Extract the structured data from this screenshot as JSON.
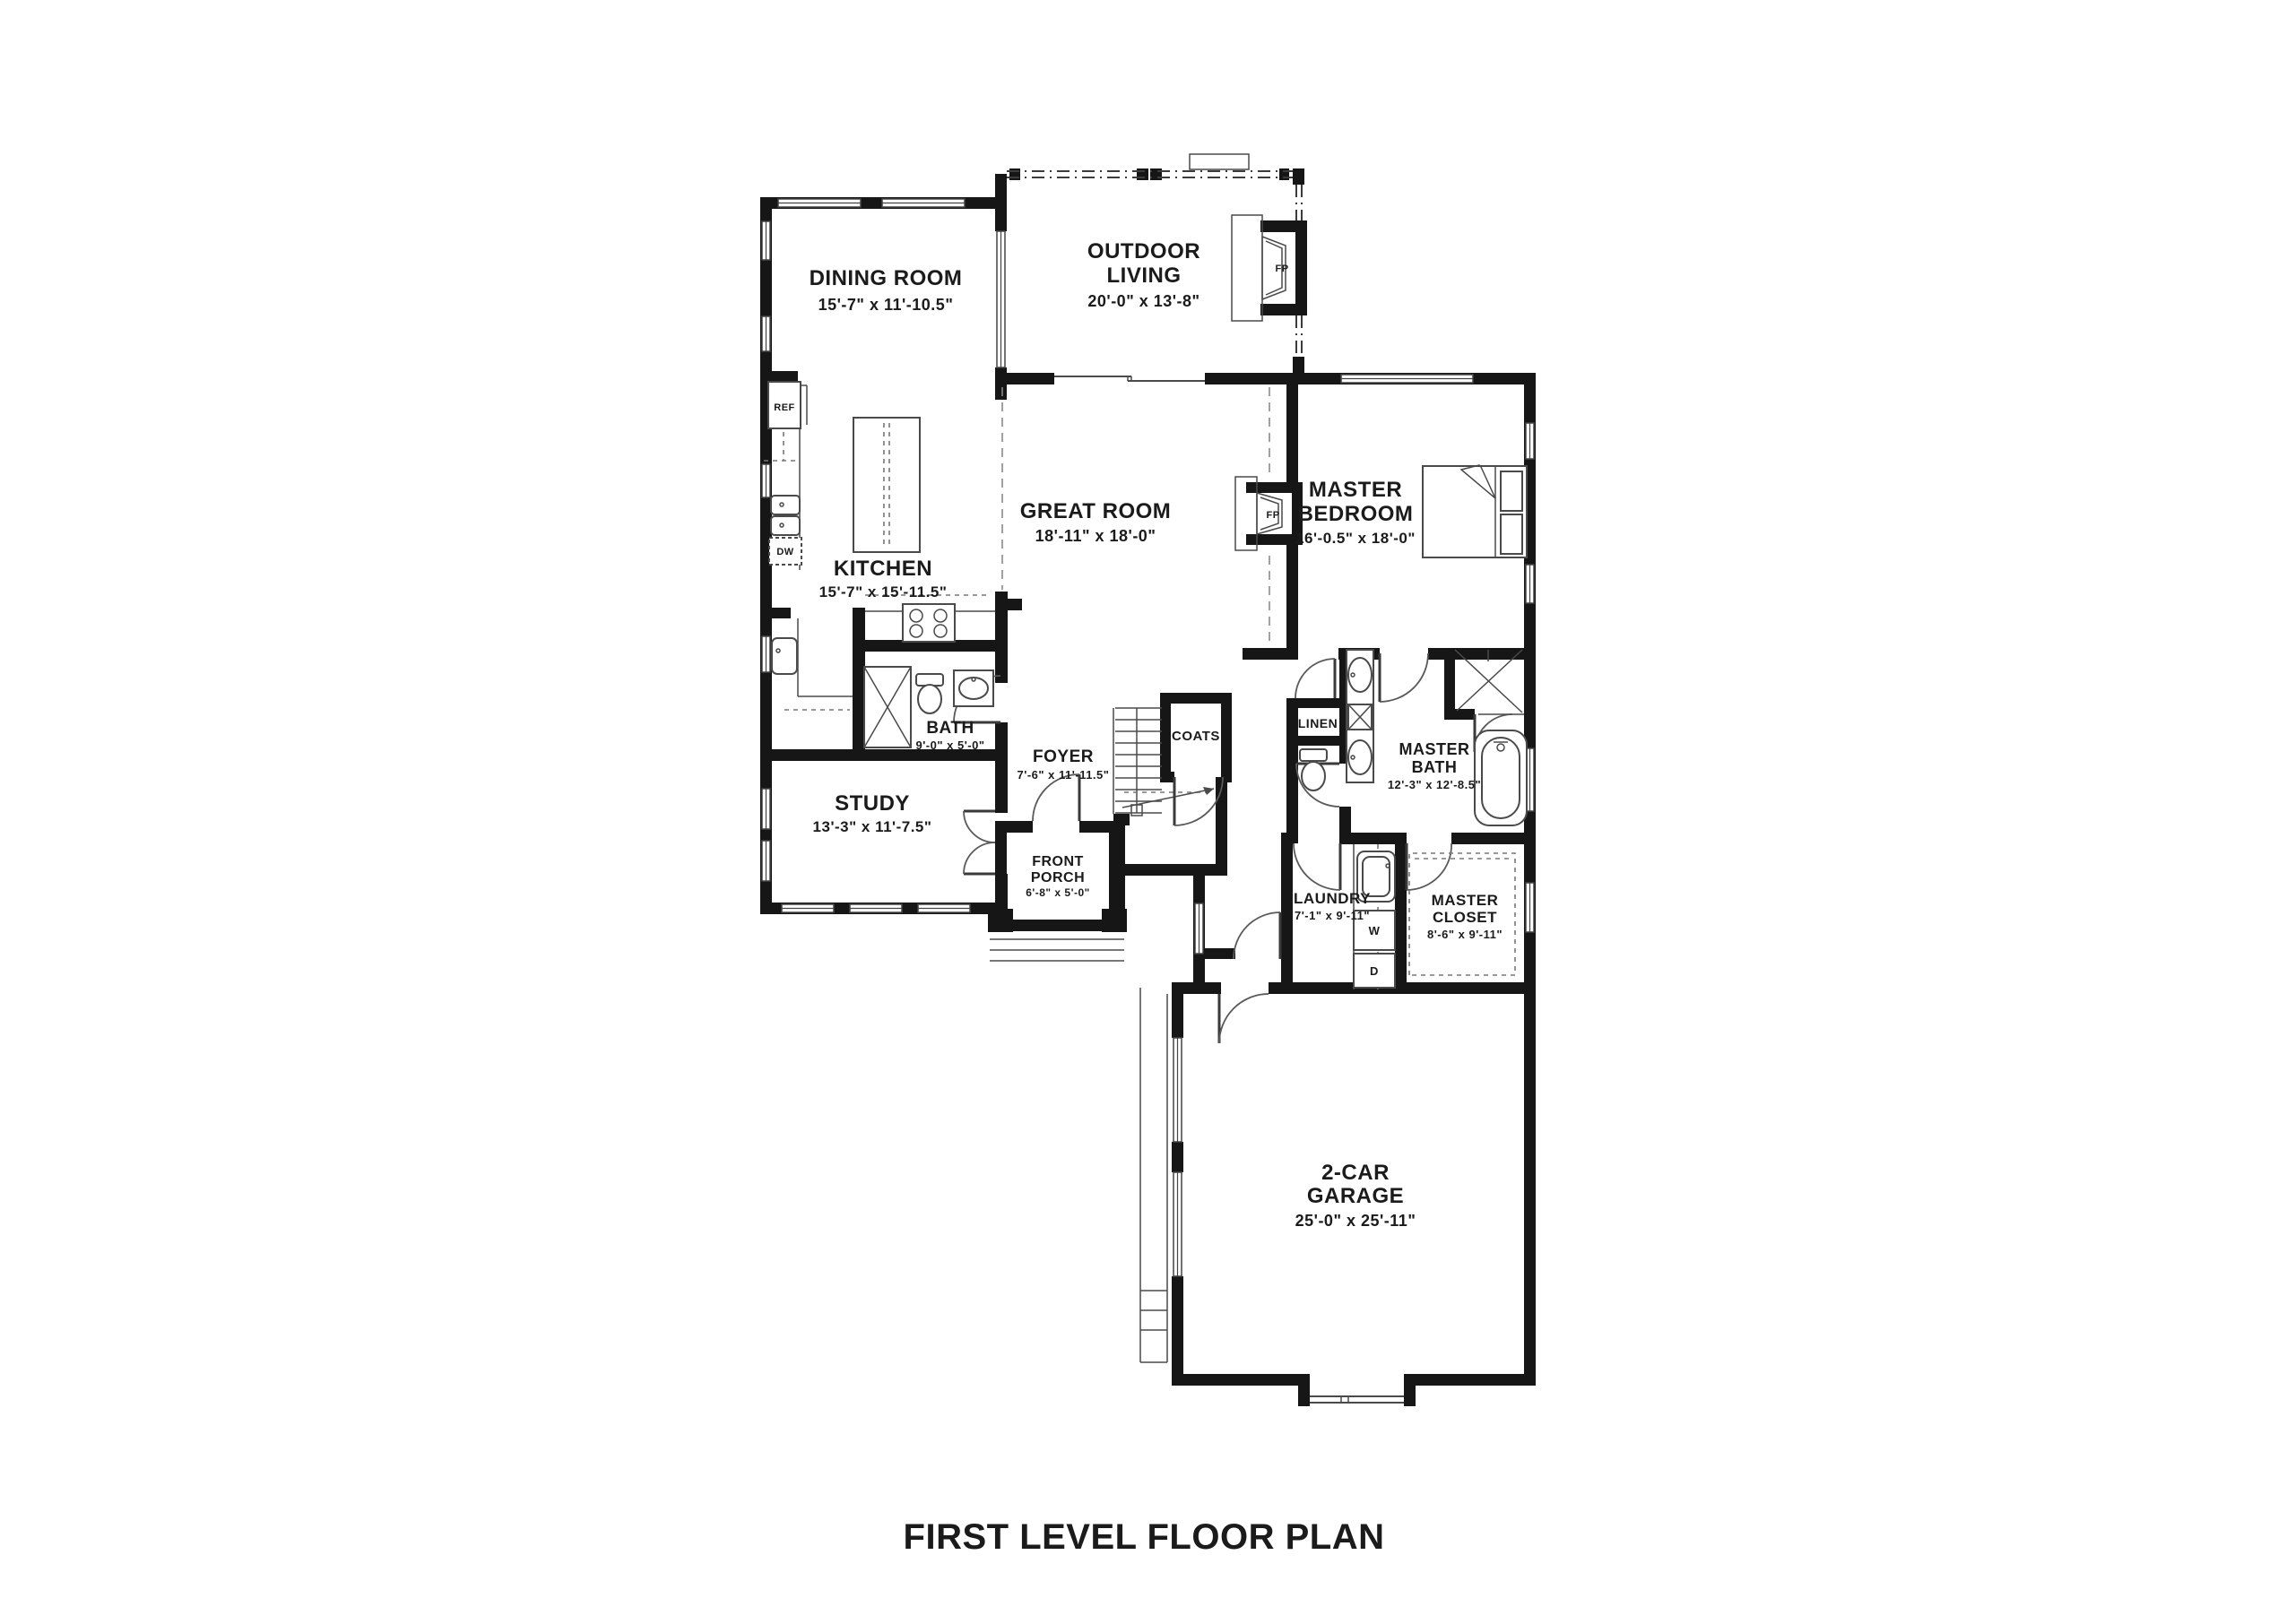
{
  "title": "FIRST LEVEL FLOOR PLAN",
  "rooms": {
    "dining": {
      "name": "DINING ROOM",
      "dims": "15'-7\" x 11'-10.5\""
    },
    "outdoor": {
      "line1": "OUTDOOR",
      "line2": "LIVING",
      "dims": "20'-0\" x 13'-8\""
    },
    "great": {
      "name": "GREAT ROOM",
      "dims": "18'-11\" x 18'-0\""
    },
    "master_bed": {
      "line1": "MASTER",
      "line2": "BEDROOM",
      "dims": "16'-0.5\" x 18'-0\""
    },
    "kitchen": {
      "name": "KITCHEN",
      "dims": "15'-7\" x 15'-11.5\""
    },
    "bath": {
      "name": "BATH",
      "dims": "9'-0\" x 5'-0\""
    },
    "foyer": {
      "name": "FOYER",
      "dims": "7'-6\" x 11'-11.5\""
    },
    "coats": {
      "name": "COATS"
    },
    "linen": {
      "name": "LINEN"
    },
    "master_bath": {
      "line1": "MASTER",
      "line2": "BATH",
      "dims": "12'-3\" x 12'-8.5\""
    },
    "study": {
      "name": "STUDY",
      "dims": "13'-3\" x 11'-7.5\""
    },
    "front_porch": {
      "line1": "FRONT",
      "line2": "PORCH",
      "dims": "6'-8\" x 5'-0\""
    },
    "laundry": {
      "name": "LAUNDRY",
      "dims": "7'-1\" x 9'-11\""
    },
    "master_closet": {
      "line1": "MASTER",
      "line2": "CLOSET",
      "dims": "8'-6\" x 9'-11\""
    },
    "garage": {
      "line1": "2-CAR",
      "line2": "GARAGE",
      "dims": "25'-0\" x 25'-11\""
    }
  },
  "appliances": {
    "refrigerator": "REF",
    "dishwasher": "DW",
    "washer": "W",
    "dryer": "D",
    "fireplace": "FP"
  },
  "colors": {
    "wall": "#161616",
    "line": "#4a4a4a",
    "text": "#1b1b1b",
    "background": "#ffffff"
  }
}
